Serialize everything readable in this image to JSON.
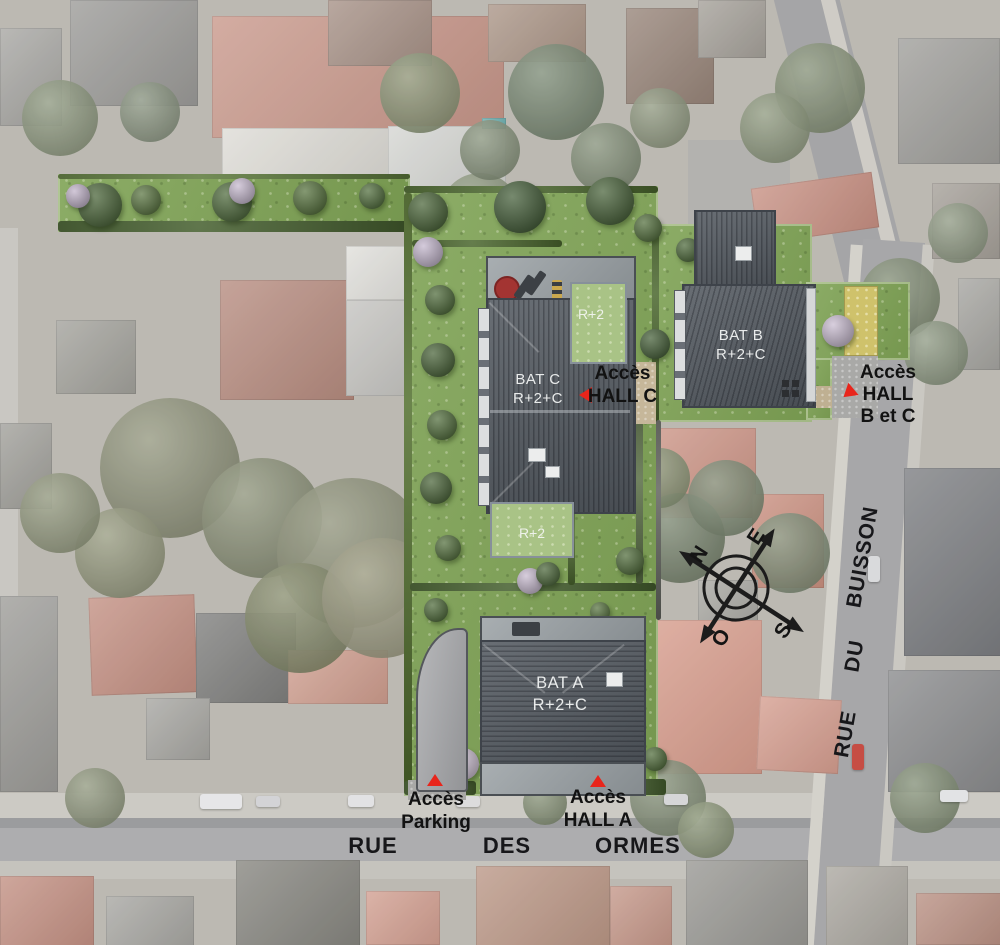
{
  "buildings": {
    "bat_c": {
      "name": "BAT C",
      "floors": "R+2+C"
    },
    "bat_b": {
      "name": "BAT B",
      "floors": "R+2+C"
    },
    "bat_a": {
      "name": "BAT A",
      "floors": "R+2+C"
    },
    "roof_north": {
      "label": "R+2"
    },
    "roof_south": {
      "label": "R+2"
    }
  },
  "access": {
    "hall_c": {
      "line1": "Accès",
      "line2": "HALL C"
    },
    "hall_bc": {
      "line1": "Accès",
      "line2": "HALL",
      "line3": "B et C"
    },
    "parking": {
      "line1": "Accès",
      "line2": "Parking"
    },
    "hall_a": {
      "line1": "Accès",
      "line2": "HALL A"
    }
  },
  "streets": {
    "ormes": {
      "word1": "RUE",
      "word2": "DES",
      "word3": "ORMES"
    },
    "buisson": {
      "word1": "RUE",
      "word2": "DU",
      "word3": "BUISSON"
    }
  },
  "compass": {
    "north": "N",
    "east": "E",
    "south": "S",
    "west": "O"
  },
  "colors": {
    "site_green": "#7fa355",
    "roof_dark": "#545a61",
    "green_roof": "#a9c386",
    "marker_red": "#e8251b",
    "label_black": "#141414",
    "roof_text": "#e9ebeb"
  }
}
